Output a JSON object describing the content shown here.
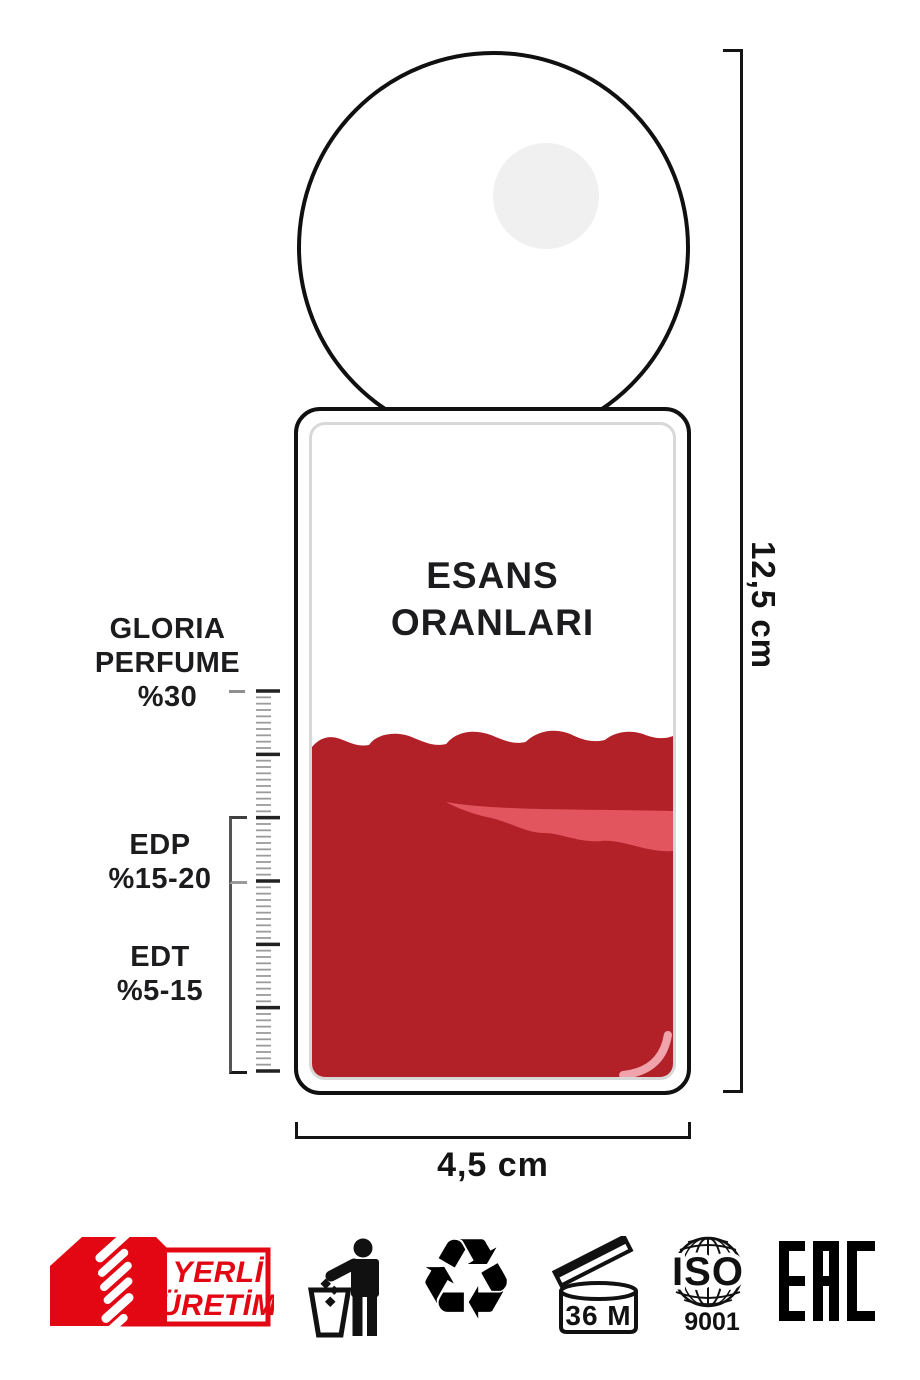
{
  "bottle": {
    "title_line1": "ESANS",
    "title_line2": "ORANLARI"
  },
  "scale_labels": {
    "gloria": {
      "line1": "GLORIA",
      "line2": "PERFUME",
      "line3": "%30"
    },
    "edp": {
      "line1": "EDP",
      "line2": "%15-20"
    },
    "edt": {
      "line1": "EDT",
      "line2": "%5-15"
    }
  },
  "dimensions": {
    "height_label": "12,5 cm",
    "width_label": "4,5 cm"
  },
  "footer": {
    "yerli": {
      "line1": "YERLİ",
      "line2": "ÜRETİM"
    },
    "recycle_glyph": "♻",
    "pao": {
      "label": "36 M"
    },
    "iso": {
      "title": "ISO",
      "subtitle": "9001"
    },
    "eac": {
      "label": "EAC"
    }
  },
  "colors": {
    "ink": "#101010",
    "liquid_red": "#B32128",
    "liquid_streak": "#E2555E",
    "badge_red": "#E30613",
    "inner_outline": "#D8D8D8",
    "cap_highlight": "#F0F0F0"
  }
}
